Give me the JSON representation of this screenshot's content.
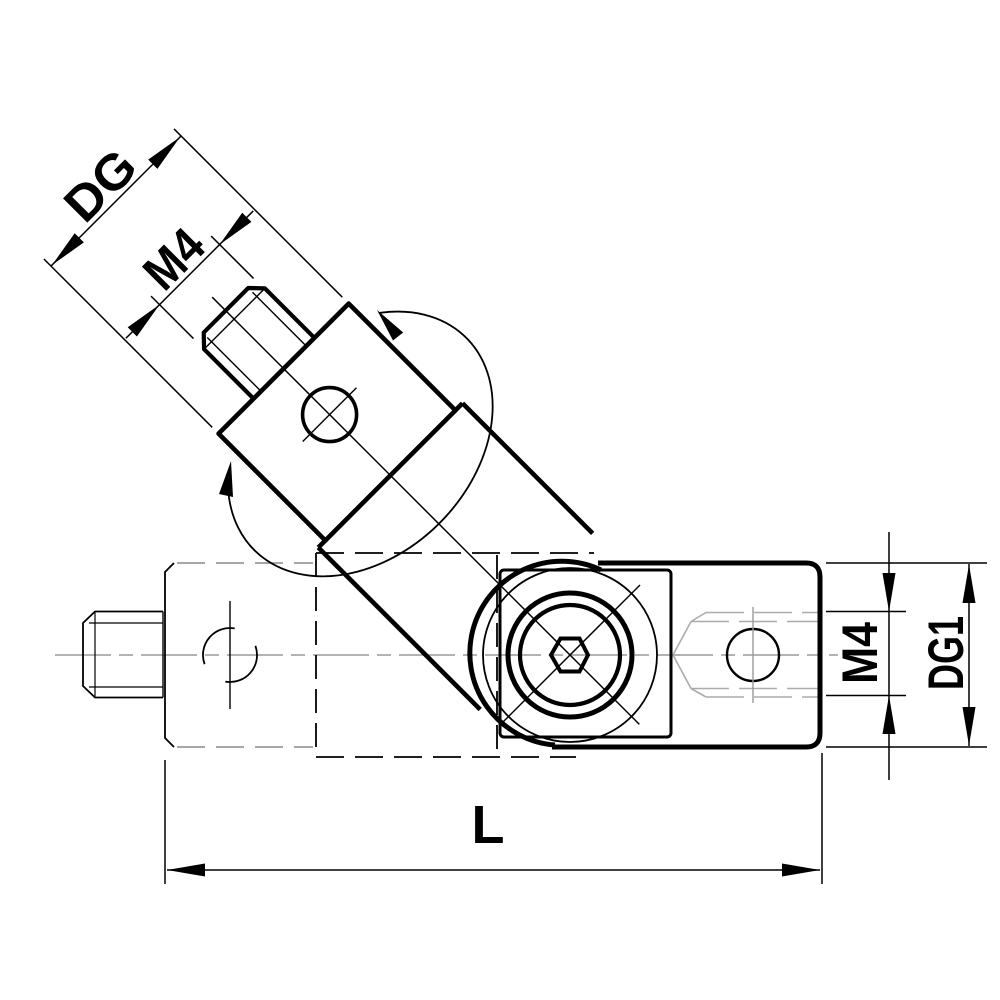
{
  "drawing": {
    "background_color": "#ffffff",
    "line_color": "#000000",
    "phantom_dash_color": "#8a8a8a",
    "centerline_color": "#9a9a9a",
    "hidden_detail_color": "#ababab",
    "labels": {
      "stud_diameter": "DG",
      "stud_thread": "M4",
      "body_thread": "M4",
      "body_diameter": "DG1",
      "overall_length": "L"
    }
  }
}
